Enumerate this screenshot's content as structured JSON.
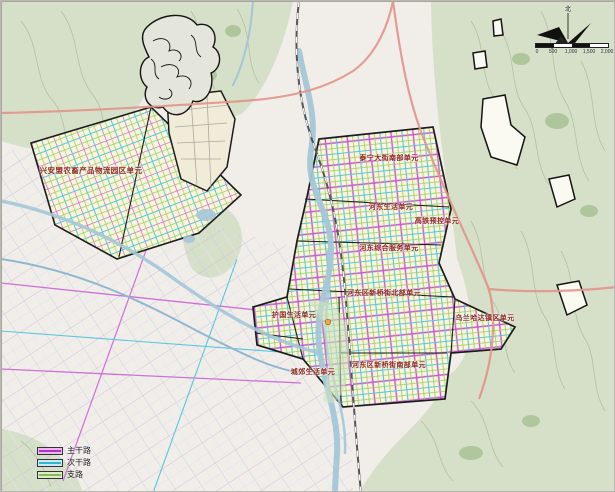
{
  "map": {
    "description_labels": [
      {
        "text": "兴安盟农畜产品物流园区单元"
      },
      {
        "text": "泰宁大街南部单元"
      },
      {
        "text": "河东生活单元"
      },
      {
        "text": "高铁预控单元"
      },
      {
        "text": "河东综合服务单元"
      },
      {
        "text": "河东区新桥街北部单元"
      },
      {
        "text": "护国生活单元"
      },
      {
        "text": "城郊生活单元"
      },
      {
        "text": "河东区新桥街南部单元"
      },
      {
        "text": "乌兰哈达镇区单元"
      }
    ],
    "legend": {
      "items": [
        {
          "label": "主干路",
          "color": "#b52fc4"
        },
        {
          "label": "次干路",
          "color": "#2fb6d6"
        },
        {
          "label": "支路",
          "color": "#86bb4f"
        }
      ]
    },
    "north": {
      "label": "北"
    },
    "scale_bar": {
      "ticks": [
        "0",
        "500",
        "1,000",
        "1,500",
        "2,000"
      ]
    },
    "colors": {
      "planning_unit_fill": "#f8f5da",
      "terrain_green": "#d6dfc8",
      "river_blue": "#a4c6d8",
      "highway_salmon": "#e2938a"
    }
  }
}
